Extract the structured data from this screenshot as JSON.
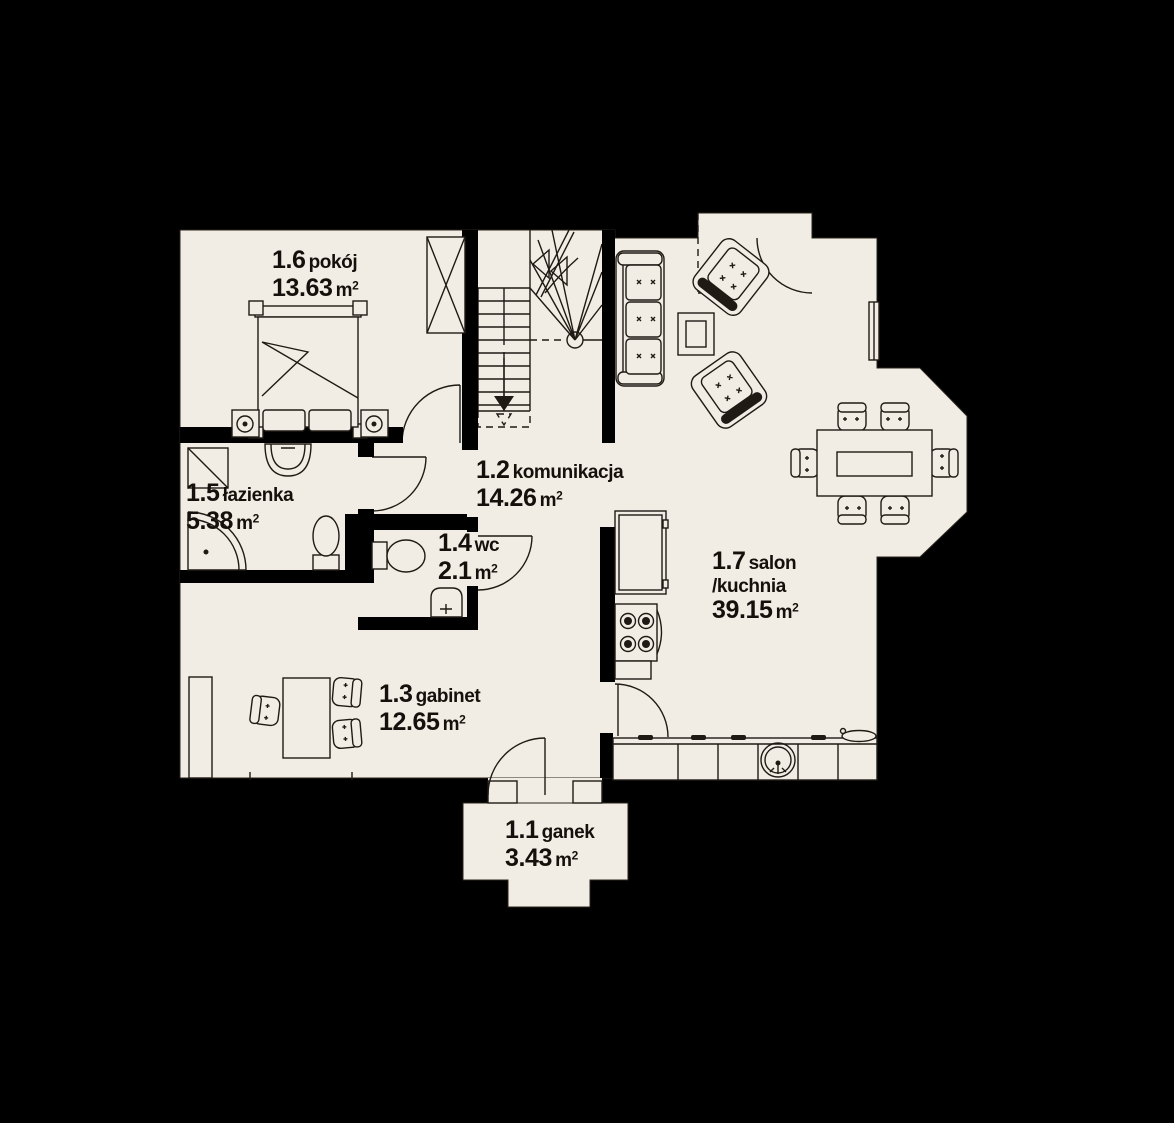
{
  "colors": {
    "background": "#000000",
    "floor": "#f2ede4",
    "line": "#1f1a14",
    "wall": "#000000",
    "label_text": "#15100c"
  },
  "rooms": [
    {
      "code": "1.1",
      "name": "ganek",
      "area": "3.43",
      "unit": "m",
      "sup": "2"
    },
    {
      "code": "1.2",
      "name": "komunikacja",
      "area": "14.26",
      "unit": "m",
      "sup": "2"
    },
    {
      "code": "1.3",
      "name": "gabinet",
      "area": "12.65",
      "unit": "m",
      "sup": "2"
    },
    {
      "code": "1.4",
      "name": "wc",
      "area": "2.1",
      "unit": "m",
      "sup": "2"
    },
    {
      "code": "1.5",
      "name": "łazienka",
      "area": "5.38",
      "unit": "m",
      "sup": "2"
    },
    {
      "code": "1.6",
      "name": "pokój",
      "area": "13.63",
      "unit": "m",
      "sup": "2"
    },
    {
      "code": "1.7",
      "name": "salon",
      "name2": "/kuchnia",
      "area": "39.15",
      "unit": "m",
      "sup": "2"
    }
  ]
}
